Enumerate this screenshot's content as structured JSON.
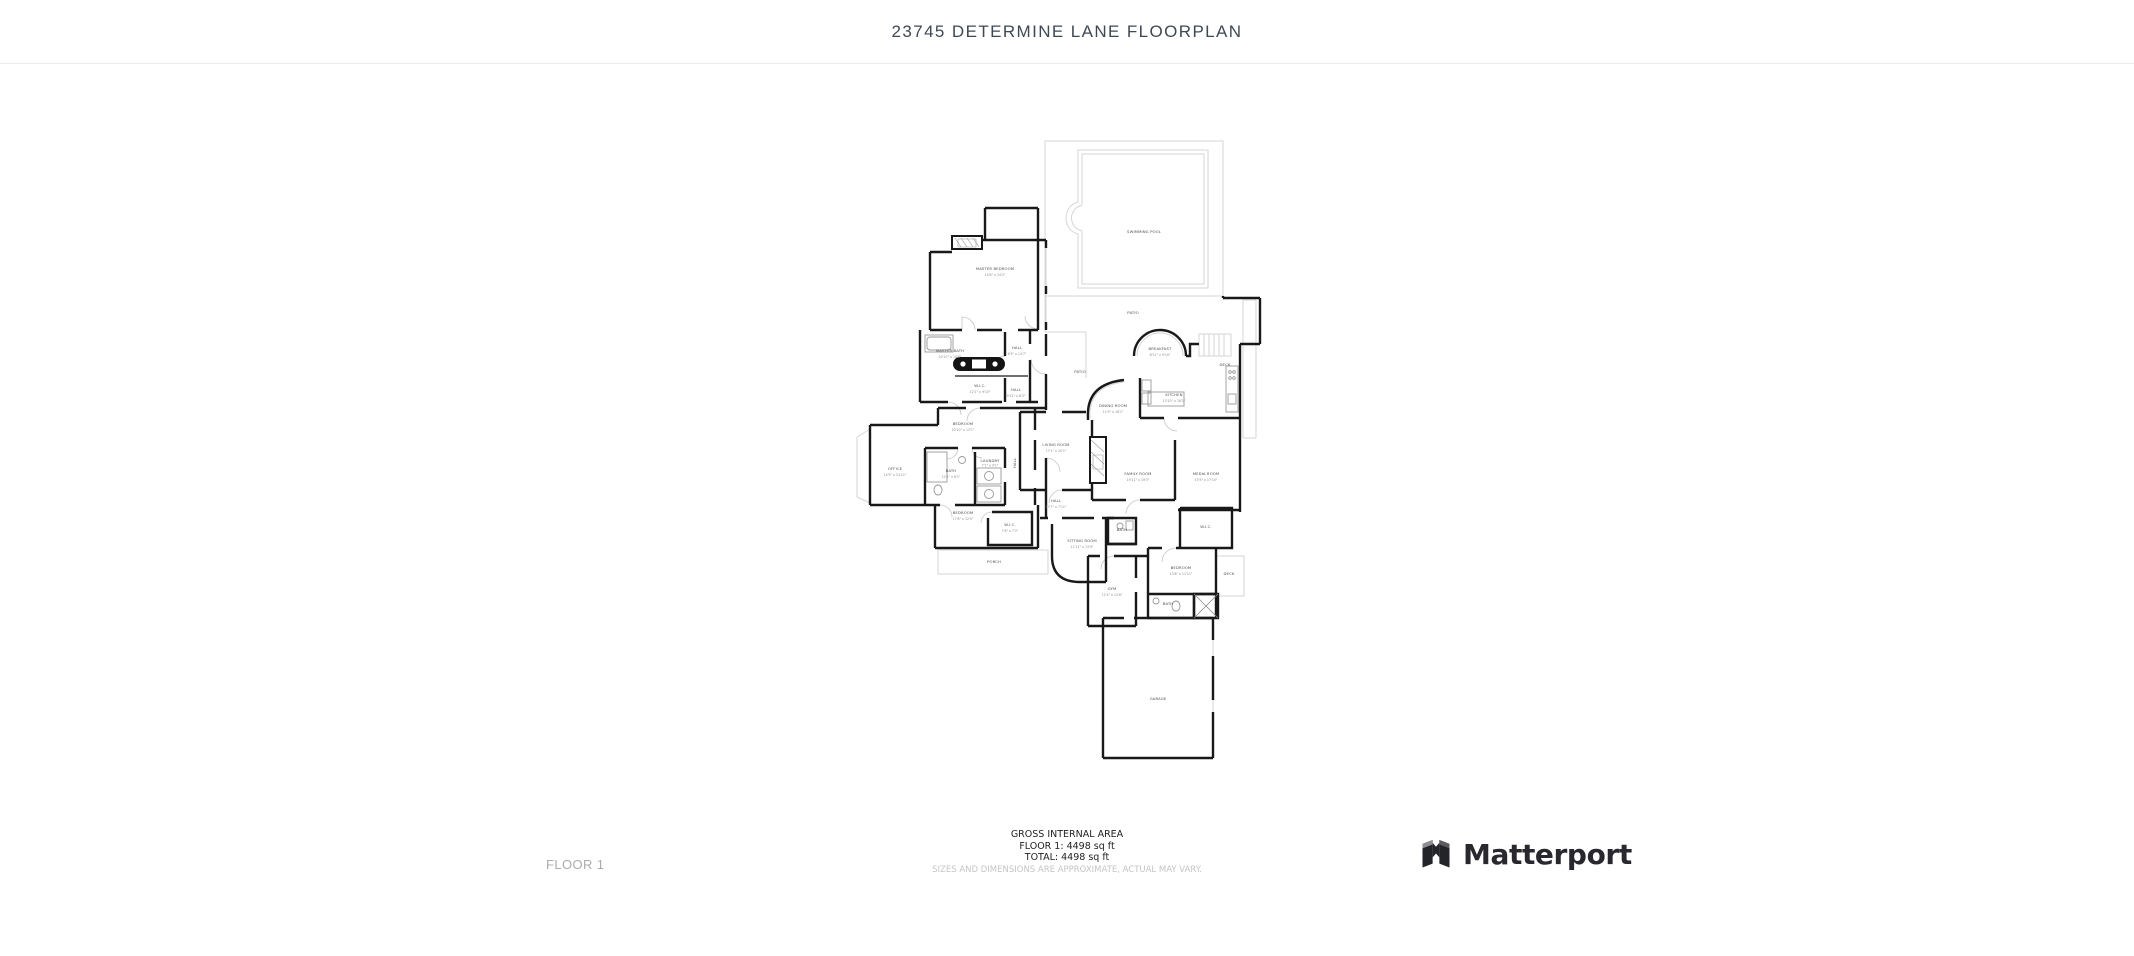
{
  "header": {
    "title": "23745 DETERMINE LANE FLOORPLAN"
  },
  "floorplan": {
    "rooms": {
      "swimming_pool": {
        "name": "SWIMMING POOL",
        "dims": ""
      },
      "patio_upper": {
        "name": "PATIO",
        "dims": ""
      },
      "patio_terrace": {
        "name": "PATIO",
        "dims": ""
      },
      "master_bedroom": {
        "name": "MASTER BEDROOM",
        "dims": "14'8\" x 24'2\""
      },
      "master_bath": {
        "name": "MASTER BATH",
        "dims": "20'10\" x 14'8\""
      },
      "wic_master": {
        "name": "W.I.C.",
        "dims": "12'1\" x 9'10\""
      },
      "hall_upper": {
        "name": "HALL",
        "dims": "6'5\" x 14'7\""
      },
      "hall_mid": {
        "name": "HALL",
        "dims": "9'11\" x 8'3\""
      },
      "hall_vertical": {
        "name": "HALL",
        "dims": ""
      },
      "breakfast": {
        "name": "BREAKFAST",
        "dims": "8'11\" x 9'10\""
      },
      "kitchen": {
        "name": "KITCHEN",
        "dims": "13'10\" x 16'1\""
      },
      "dining_room": {
        "name": "DINING ROOM",
        "dims": "11'9\" x 18'1\""
      },
      "deck_right": {
        "name": "DECK",
        "dims": ""
      },
      "living_room": {
        "name": "LIVING ROOM",
        "dims": "17'1\" x 20'1\""
      },
      "bedroom_2": {
        "name": "BEDROOM",
        "dims": "10'10\" x 13'1\""
      },
      "office": {
        "name": "OFFICE",
        "dims": "14'5\" x 14'11\""
      },
      "bath_2": {
        "name": "BATH",
        "dims": "12'1\" x 6'1\""
      },
      "laundry": {
        "name": "LAUNDRY",
        "dims": "7'1\" x 9'1\""
      },
      "bedroom_3": {
        "name": "BEDROOM",
        "dims": "17'8\" x 12'0\""
      },
      "wic_2": {
        "name": "W.I.C.",
        "dims": "7'8\" x 7'2\""
      },
      "porch": {
        "name": "PORCH",
        "dims": ""
      },
      "hall_lower": {
        "name": "HALL",
        "dims": "27'7\" x 7'11\""
      },
      "family_room": {
        "name": "FAMILY ROOM",
        "dims": "19'11\" x 19'3\""
      },
      "media_room": {
        "name": "MEDIA ROOM",
        "dims": "13'5\" x 17'10\""
      },
      "sitting_room": {
        "name": "SITTING ROOM",
        "dims": "11'11\" x 13'9\""
      },
      "bath_3": {
        "name": "BATH",
        "dims": ""
      },
      "wic_3": {
        "name": "W.I.C.",
        "dims": ""
      },
      "bedroom_4": {
        "name": "BEDROOM",
        "dims": "13'8\" x 11'11\""
      },
      "deck_lower": {
        "name": "DECK",
        "dims": ""
      },
      "gym": {
        "name": "GYM",
        "dims": "11'4\" x 12'8\""
      },
      "bath_4": {
        "name": "BATH",
        "dims": ""
      },
      "garage": {
        "name": "GARAGE",
        "dims": ""
      }
    }
  },
  "footer": {
    "floor_label": "FLOOR 1",
    "area_summary": {
      "heading": "GROSS INTERNAL AREA",
      "floor_line": "FLOOR 1: 4498 sq ft",
      "total_line": "TOTAL: 4498 sq ft",
      "disclaimer": "SIZES AND DIMENSIONS ARE APPROXIMATE, ACTUAL MAY VARY."
    },
    "brand": {
      "name": "Matterport",
      "icon": "matterport-logo-icon"
    }
  },
  "colors": {
    "title": "#3e4954",
    "header_border": "#ececec",
    "walls": "#191919",
    "light_lines": "#d6d6d6",
    "floor_label": "#acacac",
    "disclaimer": "#c5c5c5",
    "brand_text": "#28282e"
  }
}
